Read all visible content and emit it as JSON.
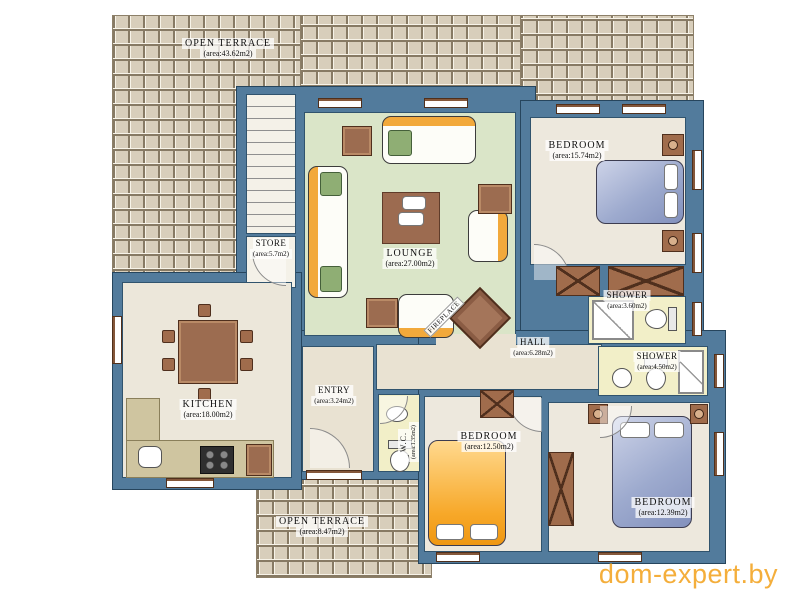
{
  "watermark": "dom-expert.by",
  "rooms": {
    "terrace_top": {
      "name": "OPEN TERRACE",
      "area": "(area:43.62m2)"
    },
    "store": {
      "name": "STORE",
      "area": "(area:5.7m2)"
    },
    "lounge": {
      "name": "LOUNGE",
      "area": "(area:27.00m2)"
    },
    "bedroom_top": {
      "name": "BEDROOM",
      "area": "(area:15.74m2)"
    },
    "shower_top": {
      "name": "SHOWER",
      "area": "(area:3.60m2)"
    },
    "hall": {
      "name": "HALL",
      "area": "(area:6.28m2)"
    },
    "shower_right": {
      "name": "SHOWER",
      "area": "(area:4.50m2)"
    },
    "kitchen": {
      "name": "KITCHEN",
      "area": "(area:18.00m2)"
    },
    "entry": {
      "name": "ENTRY",
      "area": "(area:3.24m2)"
    },
    "wc": {
      "name": "W.C.",
      "area": "(area:1.35m2)"
    },
    "bedroom_mid": {
      "name": "BEDROOM",
      "area": "(area:12.50m2)"
    },
    "bedroom_right": {
      "name": "BEDROOM",
      "area": "(area:12.39m2)"
    },
    "terrace_bottom": {
      "name": "OPEN TERRACE",
      "area": "(area:8.47m2)"
    },
    "fireplace": {
      "name": "FIREPLACE"
    }
  },
  "colors": {
    "wall": "#527b9c",
    "lounge_floor": "#dae5c8",
    "room_floor": "#ede8dd",
    "wet_floor": "#f2efc8",
    "terrace_tile": "#d8cebb",
    "accent_orange": "#f2a93b",
    "watermark_orange": "#f4ae3b"
  }
}
